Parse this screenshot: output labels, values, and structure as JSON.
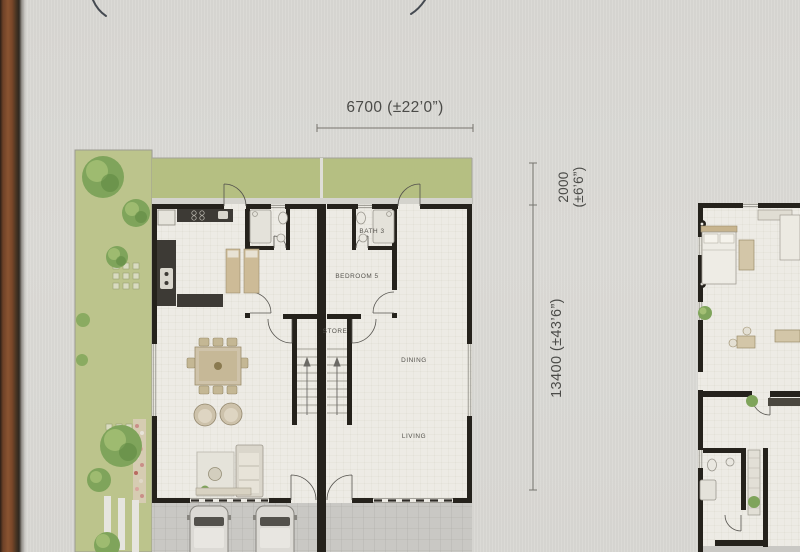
{
  "plan": {
    "dimensions": {
      "width": "6700 (±22’0”)",
      "rear_line1": "2000",
      "rear_line2": "(±6’6”)",
      "total_depth": "13400 (±43’6”)"
    },
    "rooms": {
      "bath3": "BATH 3",
      "bedroom5": "BEDROOM 5",
      "store": "STORE",
      "dining": "DINING",
      "living": "LIVING"
    }
  },
  "colors": {
    "paper": "#d9d8d4",
    "wood_edge": "#8a5431",
    "lawn": "#bcc48c",
    "wall_ink": "#25221c",
    "floor": "#edebe5",
    "porch": "#c9c8c4",
    "dim_text": "#4b4b48",
    "label_text": "#54524c"
  }
}
